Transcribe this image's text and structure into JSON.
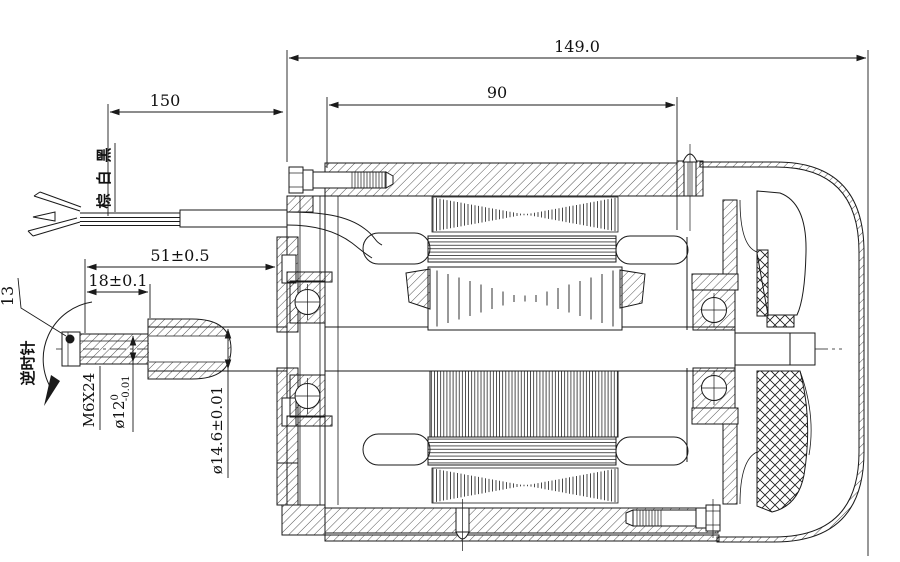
{
  "drawing": {
    "title": "motor-cross-section",
    "dimensions": {
      "overall_length": "149.0",
      "lead_wire_length": "150",
      "mounting_span": "90",
      "shaft_extension": "51±0.5",
      "thread_length": "18±0.1",
      "shaft_flat": "13",
      "thread_spec": "M6X24",
      "shaft_dia_small": {
        "base": "ø12",
        "tol_upper": "0",
        "tol_lower": "-0.01"
      },
      "shaft_dia_large": "ø14.6±0.01"
    },
    "labels": {
      "rotation_direction": "逆时针",
      "wire_color_top": "黑",
      "wire_color_middle": "白",
      "wire_color_bottom": "棕"
    },
    "colors": {
      "line": "#1a1a1a",
      "background": "#ffffff"
    }
  }
}
